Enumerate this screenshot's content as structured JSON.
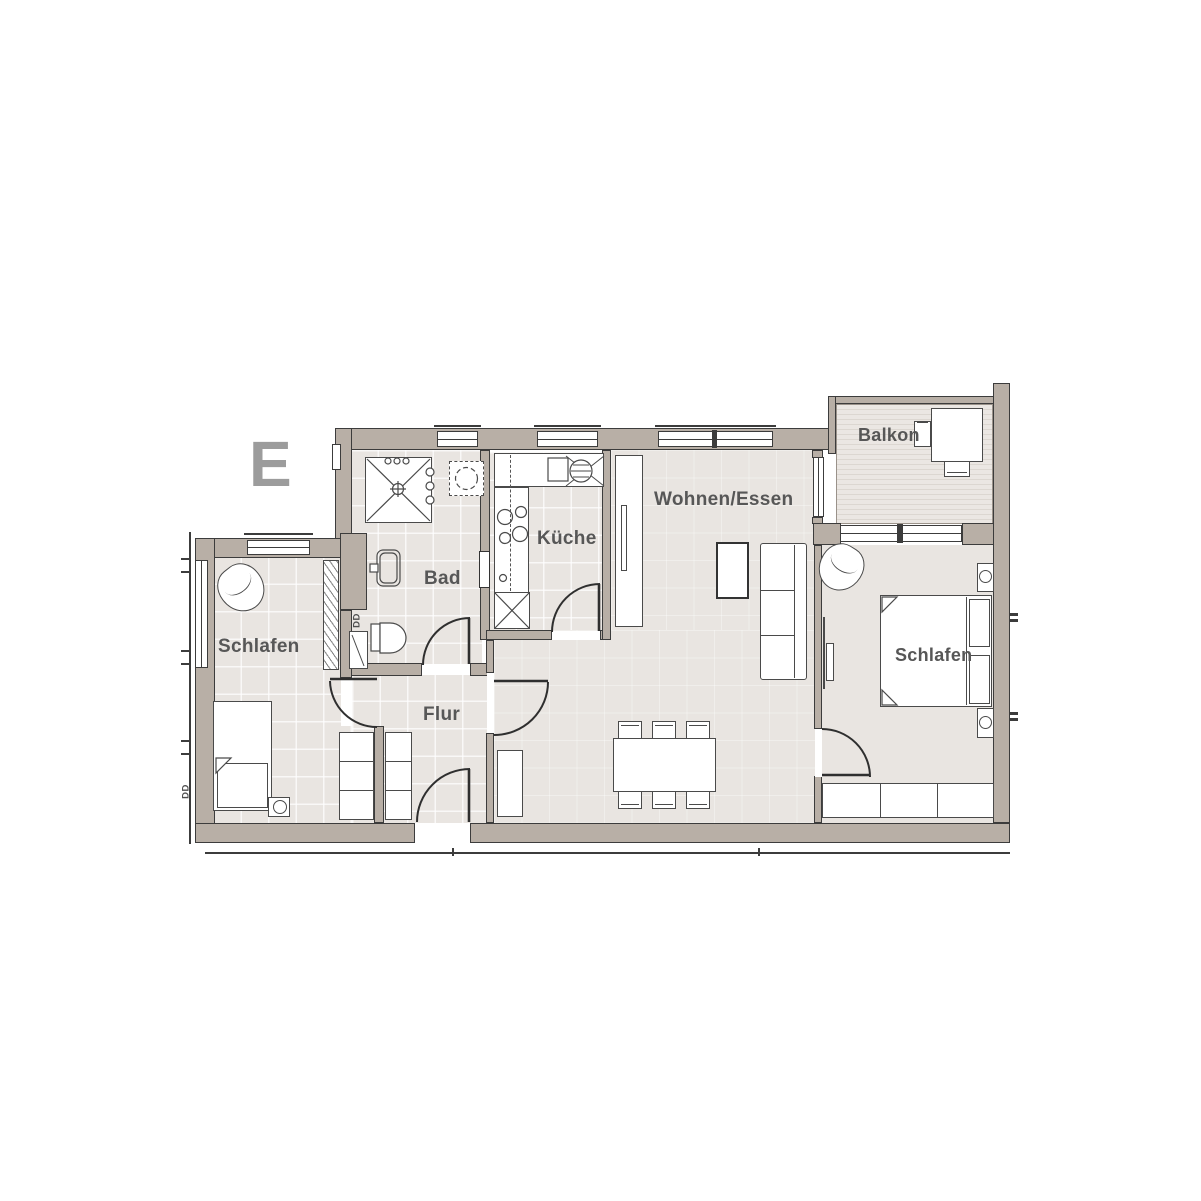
{
  "plan": {
    "unit_mark": "E",
    "rooms": [
      {
        "id": "schlafen-west",
        "label": "Schlafen"
      },
      {
        "id": "bad",
        "label": "Bad"
      },
      {
        "id": "kueche",
        "label": "Küche"
      },
      {
        "id": "flur",
        "label": "Flur"
      },
      {
        "id": "wohnen-essen",
        "label": "Wohnen/Essen"
      },
      {
        "id": "balkon",
        "label": "Balkon"
      },
      {
        "id": "schlafen-ost",
        "label": "Schlafen"
      }
    ],
    "shaft_labels": [
      {
        "id": "shaft-bad",
        "text": "DD"
      },
      {
        "id": "shaft-west-wall",
        "text": "DD"
      }
    ]
  },
  "colors": {
    "wall_fill": "#b8afa6",
    "wall_outline": "#3c3c3c",
    "floor_fill": "#e9e5e1",
    "furniture_outline": "#4a4a4a",
    "label_text": "#575757",
    "unit_mark_text": "#9c9c9c",
    "balcony_stripe": "#dcd7d1"
  }
}
